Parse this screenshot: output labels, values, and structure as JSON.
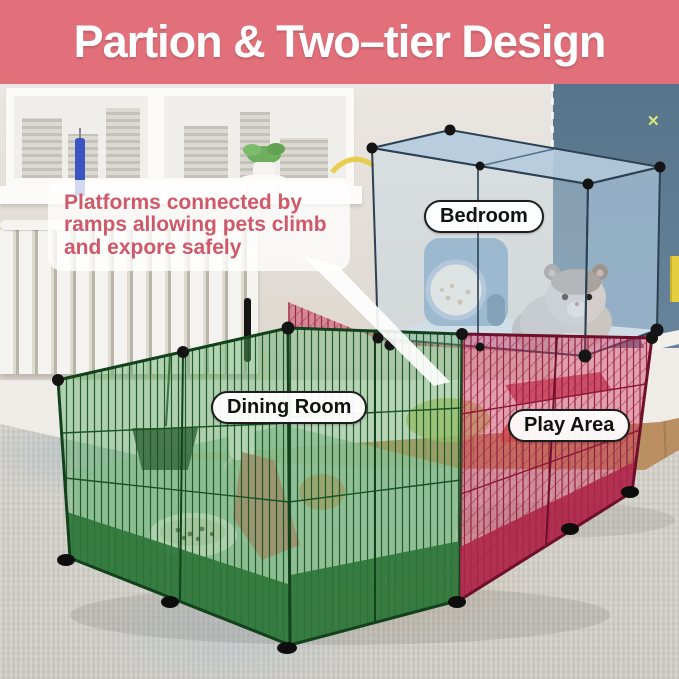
{
  "header": {
    "title": "Partion & Two–tier Design"
  },
  "annotation": {
    "text": "Platforms connected by ramps allowing pets climb and expore safely"
  },
  "labels": {
    "bedroom": "Bedroom",
    "dining_room": "Dining Room",
    "play_area": "Play Area"
  },
  "decor": {
    "wall_mark": "✕"
  },
  "colors": {
    "header_bg": "#e2707b",
    "annotation_text": "#cf5968",
    "wall_left": "#eae6e1",
    "wall_right": "#56748a",
    "wood_floor": "#c49a6b",
    "rug_base": "#d8d5cf",
    "bedroom_tint": "#c3d7e7",
    "dining_green": "#2c7439",
    "play_red": "#c73a5e"
  }
}
